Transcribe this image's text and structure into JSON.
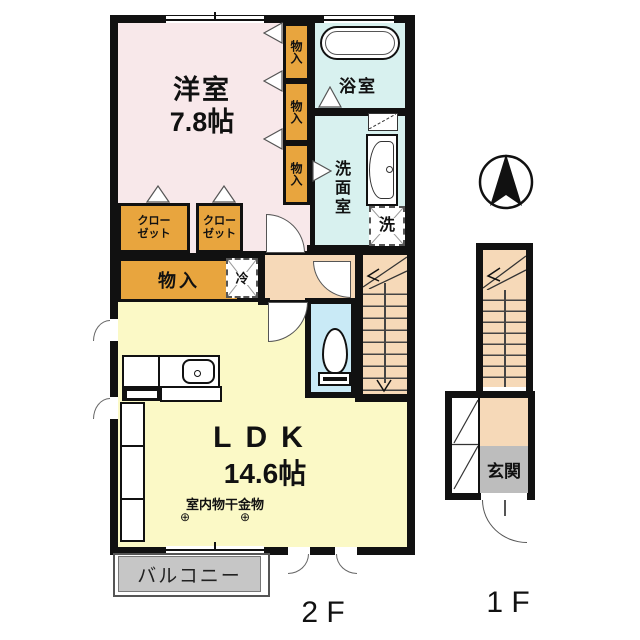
{
  "fp": {
    "floor2_label": "2 F",
    "floor1_label": "1 F",
    "western_room": {
      "name": "洋室",
      "size": "7.8帖"
    },
    "ldk": {
      "name": "LDK",
      "size": "14.6帖"
    },
    "bathroom": "浴室",
    "washroom": "洗面室",
    "entrance": "玄関",
    "balcony": "バルコニー",
    "closet_line1": "クロー",
    "closet_line2": "ゼット",
    "storage_items": [
      "物入",
      "物入",
      "物入"
    ],
    "storage_room": "物入",
    "refrigerator": "冷",
    "washer": "洗",
    "laundry_hardware": "室内物干金物",
    "laundry_symbol": "⊕",
    "colors": {
      "wall": "#111111",
      "western_room": "#f8e8ea",
      "ldk": "#fbf9c6",
      "bath_wash": "#d8f1ef",
      "toilet": "#c9eaf6",
      "hall_stairs": "#f6d9b8",
      "storage_fill": "#e8a53e",
      "balcony": "#c6c6c6",
      "entrance": "#bdbdbd"
    }
  }
}
